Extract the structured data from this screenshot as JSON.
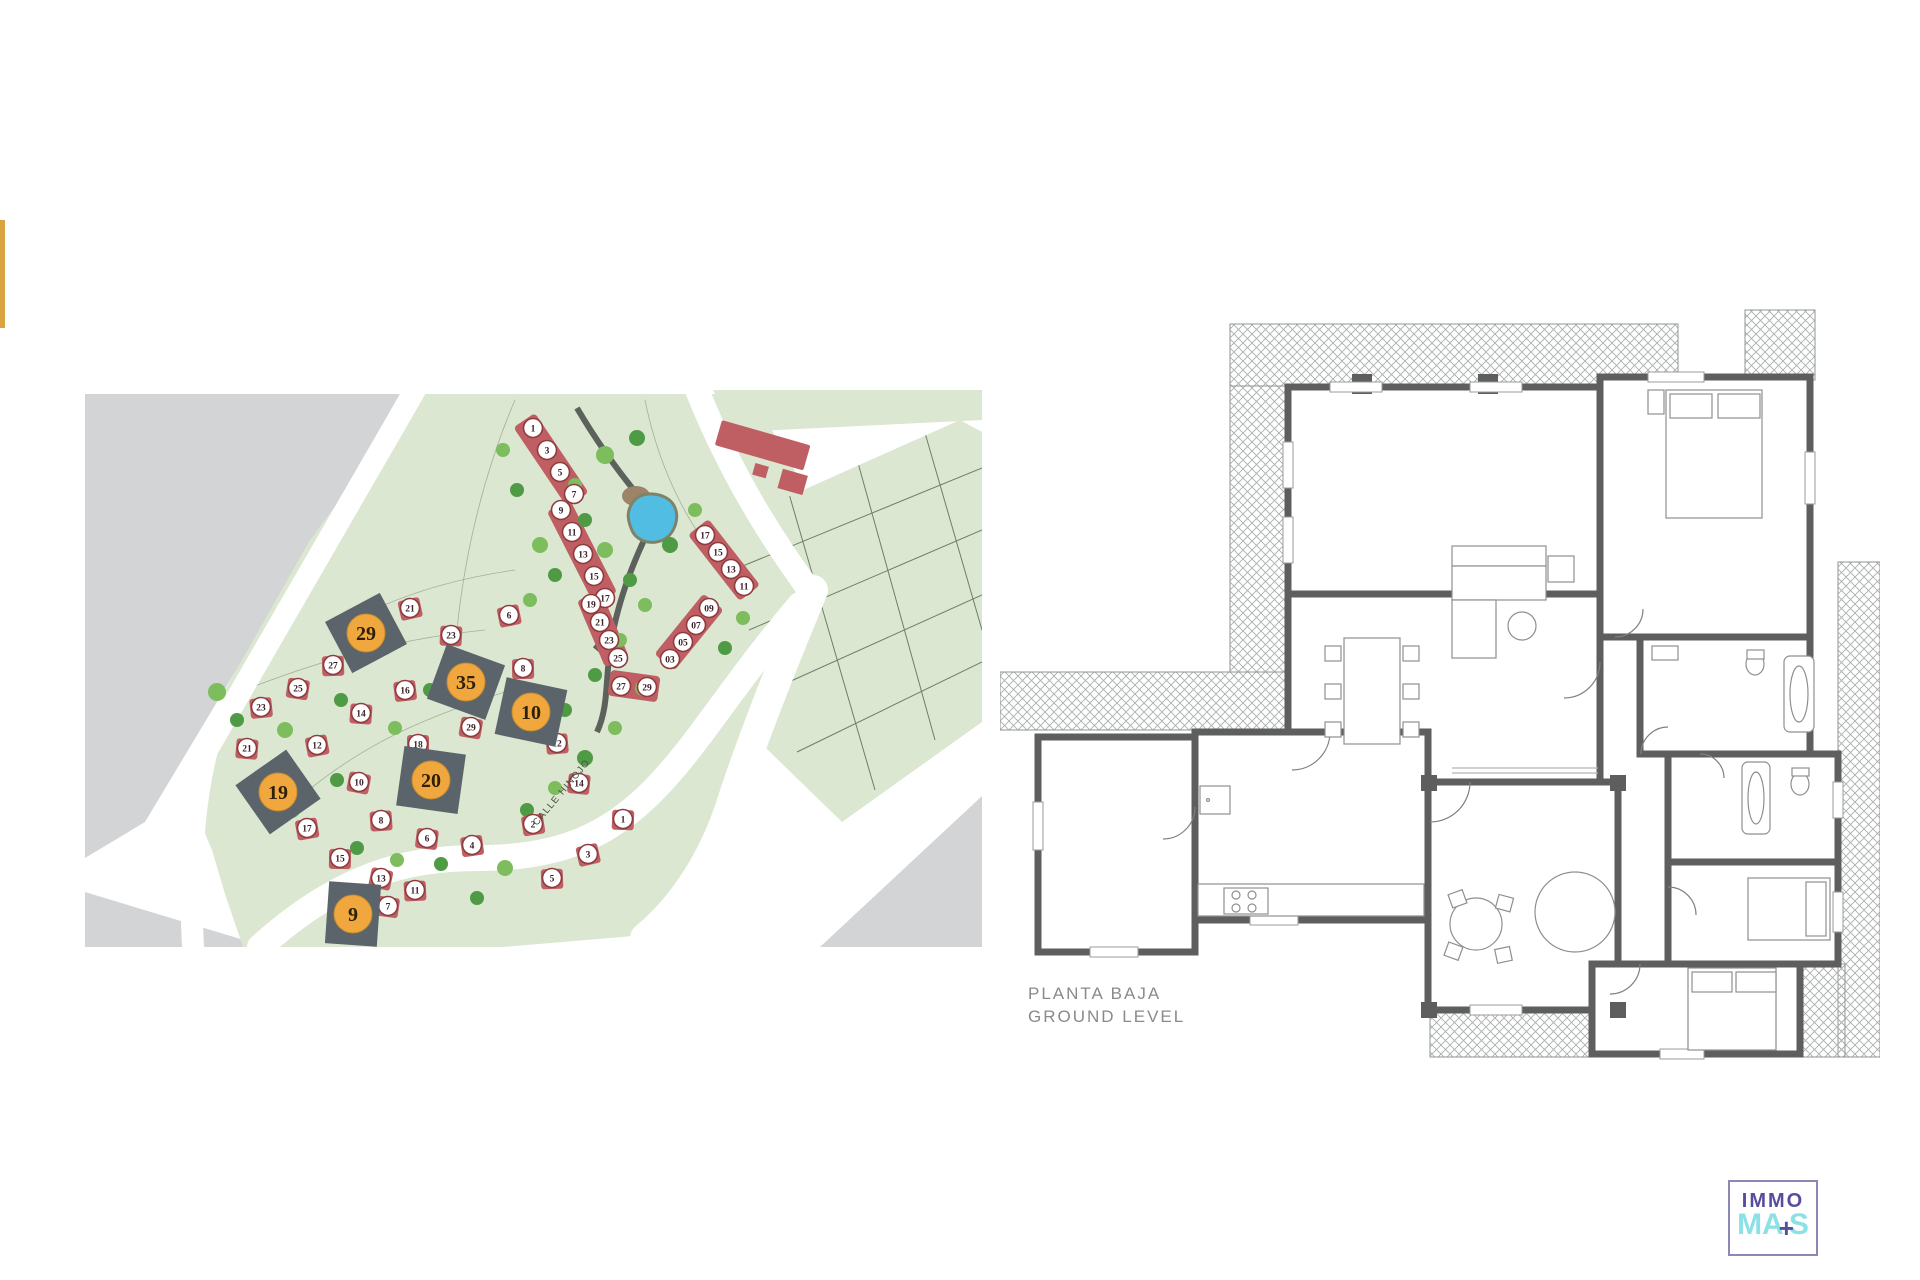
{
  "accent_color": "#d9a33f",
  "site_plan": {
    "street_label": "CALLE HINOJO",
    "colors": {
      "green": "#dbe7d1",
      "gray": "#d2d4d6",
      "road": "#ffffff",
      "house_fill": "#c05f63",
      "house_ring": "#8e3b40",
      "plot_dark": "#5a646a",
      "plot_circle": "#efa73e",
      "pond": "#52bde2",
      "tree_light": "#7dbd5e",
      "tree_dark": "#4f9a44"
    },
    "highlighted_plots": [
      {
        "n": "29",
        "x": 281,
        "y": 243,
        "w": 62,
        "h": 58,
        "rot": -28
      },
      {
        "n": "35",
        "x": 381,
        "y": 292,
        "w": 62,
        "h": 58,
        "rot": 20
      },
      {
        "n": "10",
        "x": 446,
        "y": 322,
        "w": 62,
        "h": 58,
        "rot": 12
      },
      {
        "n": "20",
        "x": 346,
        "y": 390,
        "w": 62,
        "h": 60,
        "rot": 8
      },
      {
        "n": "19",
        "x": 193,
        "y": 402,
        "w": 62,
        "h": 60,
        "rot": -35
      },
      {
        "n": "9",
        "x": 268,
        "y": 524,
        "w": 52,
        "h": 62,
        "rot": 4
      }
    ],
    "row_house_numbers": [
      {
        "n": "1",
        "x": 448,
        "y": 38
      },
      {
        "n": "3",
        "x": 462,
        "y": 60
      },
      {
        "n": "5",
        "x": 475,
        "y": 82
      },
      {
        "n": "7",
        "x": 489,
        "y": 104
      },
      {
        "n": "9",
        "x": 476,
        "y": 120
      },
      {
        "n": "11",
        "x": 487,
        "y": 142
      },
      {
        "n": "13",
        "x": 498,
        "y": 164
      },
      {
        "n": "15",
        "x": 509,
        "y": 186
      },
      {
        "n": "17",
        "x": 520,
        "y": 208
      },
      {
        "n": "19",
        "x": 506,
        "y": 214
      },
      {
        "n": "21",
        "x": 515,
        "y": 232
      },
      {
        "n": "23",
        "x": 524,
        "y": 250
      },
      {
        "n": "25",
        "x": 533,
        "y": 268
      },
      {
        "n": "27",
        "x": 536,
        "y": 296
      },
      {
        "n": "29",
        "x": 562,
        "y": 297
      },
      {
        "n": "17",
        "x": 620,
        "y": 145
      },
      {
        "n": "15",
        "x": 633,
        "y": 162
      },
      {
        "n": "13",
        "x": 646,
        "y": 179
      },
      {
        "n": "11",
        "x": 659,
        "y": 196
      },
      {
        "n": "09",
        "x": 624,
        "y": 218
      },
      {
        "n": "07",
        "x": 611,
        "y": 235
      },
      {
        "n": "05",
        "x": 598,
        "y": 252
      },
      {
        "n": "03",
        "x": 585,
        "y": 269
      }
    ],
    "detached_houses": [
      {
        "n": "21",
        "x": 325,
        "y": 218
      },
      {
        "n": "27",
        "x": 248,
        "y": 275
      },
      {
        "n": "25",
        "x": 213,
        "y": 298
      },
      {
        "n": "23",
        "x": 176,
        "y": 317
      },
      {
        "n": "21",
        "x": 162,
        "y": 358
      },
      {
        "n": "17",
        "x": 222,
        "y": 438
      },
      {
        "n": "15",
        "x": 255,
        "y": 468
      },
      {
        "n": "13",
        "x": 296,
        "y": 488
      },
      {
        "n": "11",
        "x": 330,
        "y": 500
      },
      {
        "n": "7",
        "x": 303,
        "y": 516
      },
      {
        "n": "16",
        "x": 320,
        "y": 300
      },
      {
        "n": "14",
        "x": 276,
        "y": 323
      },
      {
        "n": "12",
        "x": 232,
        "y": 355
      },
      {
        "n": "18",
        "x": 333,
        "y": 354
      },
      {
        "n": "10",
        "x": 274,
        "y": 392
      },
      {
        "n": "8",
        "x": 296,
        "y": 430
      },
      {
        "n": "6",
        "x": 342,
        "y": 448
      },
      {
        "n": "4",
        "x": 387,
        "y": 455
      },
      {
        "n": "23",
        "x": 366,
        "y": 245
      },
      {
        "n": "6",
        "x": 424,
        "y": 225
      },
      {
        "n": "8",
        "x": 438,
        "y": 278
      },
      {
        "n": "29",
        "x": 386,
        "y": 337
      },
      {
        "n": "12",
        "x": 472,
        "y": 353
      },
      {
        "n": "14",
        "x": 494,
        "y": 393
      },
      {
        "n": "2",
        "x": 448,
        "y": 434
      },
      {
        "n": "1",
        "x": 538,
        "y": 429
      },
      {
        "n": "3",
        "x": 503,
        "y": 464
      },
      {
        "n": "5",
        "x": 467,
        "y": 488
      }
    ],
    "trees": [
      [
        455,
        155,
        8,
        0
      ],
      [
        470,
        185,
        7,
        1
      ],
      [
        445,
        210,
        7,
        0
      ],
      [
        500,
        130,
        7,
        1
      ],
      [
        520,
        160,
        8,
        0
      ],
      [
        545,
        190,
        7,
        1
      ],
      [
        560,
        215,
        7,
        0
      ],
      [
        585,
        155,
        8,
        1
      ],
      [
        610,
        120,
        7,
        0
      ],
      [
        520,
        65,
        9,
        0
      ],
      [
        552,
        48,
        8,
        1
      ],
      [
        490,
        95,
        7,
        0
      ],
      [
        535,
        250,
        7,
        0
      ],
      [
        510,
        285,
        7,
        1
      ],
      [
        558,
        298,
        8,
        0
      ],
      [
        480,
        320,
        7,
        1
      ],
      [
        530,
        338,
        7,
        0
      ],
      [
        500,
        368,
        8,
        1
      ],
      [
        470,
        398,
        7,
        0
      ],
      [
        442,
        420,
        7,
        1
      ],
      [
        420,
        478,
        8,
        0
      ],
      [
        392,
        508,
        7,
        1
      ],
      [
        300,
        258,
        7,
        0
      ],
      [
        256,
        310,
        7,
        1
      ],
      [
        200,
        340,
        8,
        0
      ],
      [
        152,
        330,
        7,
        1
      ],
      [
        132,
        302,
        9,
        0
      ],
      [
        345,
        300,
        7,
        1
      ],
      [
        310,
        338,
        7,
        0
      ],
      [
        252,
        390,
        7,
        1
      ],
      [
        207,
        420,
        8,
        0
      ],
      [
        272,
        458,
        7,
        1
      ],
      [
        312,
        470,
        7,
        0
      ],
      [
        356,
        474,
        7,
        1
      ],
      [
        658,
        228,
        7,
        0
      ],
      [
        640,
        258,
        7,
        1
      ],
      [
        418,
        60,
        7,
        0
      ],
      [
        432,
        100,
        7,
        1
      ]
    ]
  },
  "floor_plan": {
    "title1": "PLANTA BAJA",
    "title2": "GROUND LEVEL",
    "rooms": [
      {
        "lines": [
          "PORCHE",
          "21.50m²"
        ],
        "x": 432,
        "y": 195
      },
      {
        "lines": [
          "SALON COMEDOR",
          "LIVING DINING ROOM",
          "37.35m²"
        ],
        "x": 520,
        "y": 438
      },
      {
        "lines": [
          "COCINA - KITCHEN",
          "12.10m²"
        ],
        "x": 315,
        "y": 566
      },
      {
        "lines": [
          "GARAJE - GARAGE",
          "20.60m²"
        ],
        "x": 114,
        "y": 558
      },
      {
        "lines": [
          "SALA - FAMILY ROOM",
          "9.80m²"
        ],
        "x": 520,
        "y": 598
      },
      {
        "lines": [
          "DORMITORIO 1 - BEDROOM 1",
          "13.20m²"
        ],
        "x": 700,
        "y": 306
      },
      {
        "lines": [
          "BAÑO 1 - BATH 1",
          "7.20m²"
        ],
        "x": 716,
        "y": 420
      },
      {
        "lines": [
          "BAÑO 2 - BATH 2",
          "4.80m²"
        ],
        "x": 742,
        "y": 552
      },
      {
        "lines": [
          "DORMITORIO 2 - BEDROOM 2",
          "10.50m²"
        ],
        "x": 708,
        "y": 652
      },
      {
        "lines": [
          "DORMITORIO 3 - BEDROOM 3",
          "12.80m²"
        ],
        "x": 664,
        "y": 740
      }
    ]
  },
  "plot_sizes": {
    "rows": [
      {
        "label": "PARCELA/PLOT SIZE 10:",
        "value": "829m²"
      },
      {
        "label": "PARCELA/PLOT SIZE 35:",
        "value": "857m²"
      },
      {
        "label": "PARCELA/PLOT SIZE 20:",
        "value": "861m²"
      },
      {
        "label": "PARCELA/PLOT SIZE 29:",
        "value": "842m²"
      },
      {
        "label": "PARCELA/PLOT SIZE 19:",
        "value": "842m²"
      },
      {
        "label": "PARCELA/PLOT SIZE 9:",
        "value": "835m²"
      }
    ]
  },
  "areas": {
    "rows": [
      {
        "label": "SUPERFICIE ÚTIL/ USEABLE AREA:",
        "sublabel": "",
        "value": "148.62m²",
        "top": 0
      },
      {
        "label": "SUP. CONSTRUIDA CUBIERTA:",
        "sublabel": "COVERED BUILT AREA",
        "value": "145.71m²",
        "top": 46
      },
      {
        "label": "SUP. CONSTRUIDA TOTAL:",
        "sublabel": "TOTAL BUILT AREA",
        "value": "178.46m²",
        "top": 108
      }
    ]
  },
  "logo": {
    "top": "IMMO",
    "bottom_a": "MA",
    "plus": "+",
    "bottom_b": "S"
  }
}
